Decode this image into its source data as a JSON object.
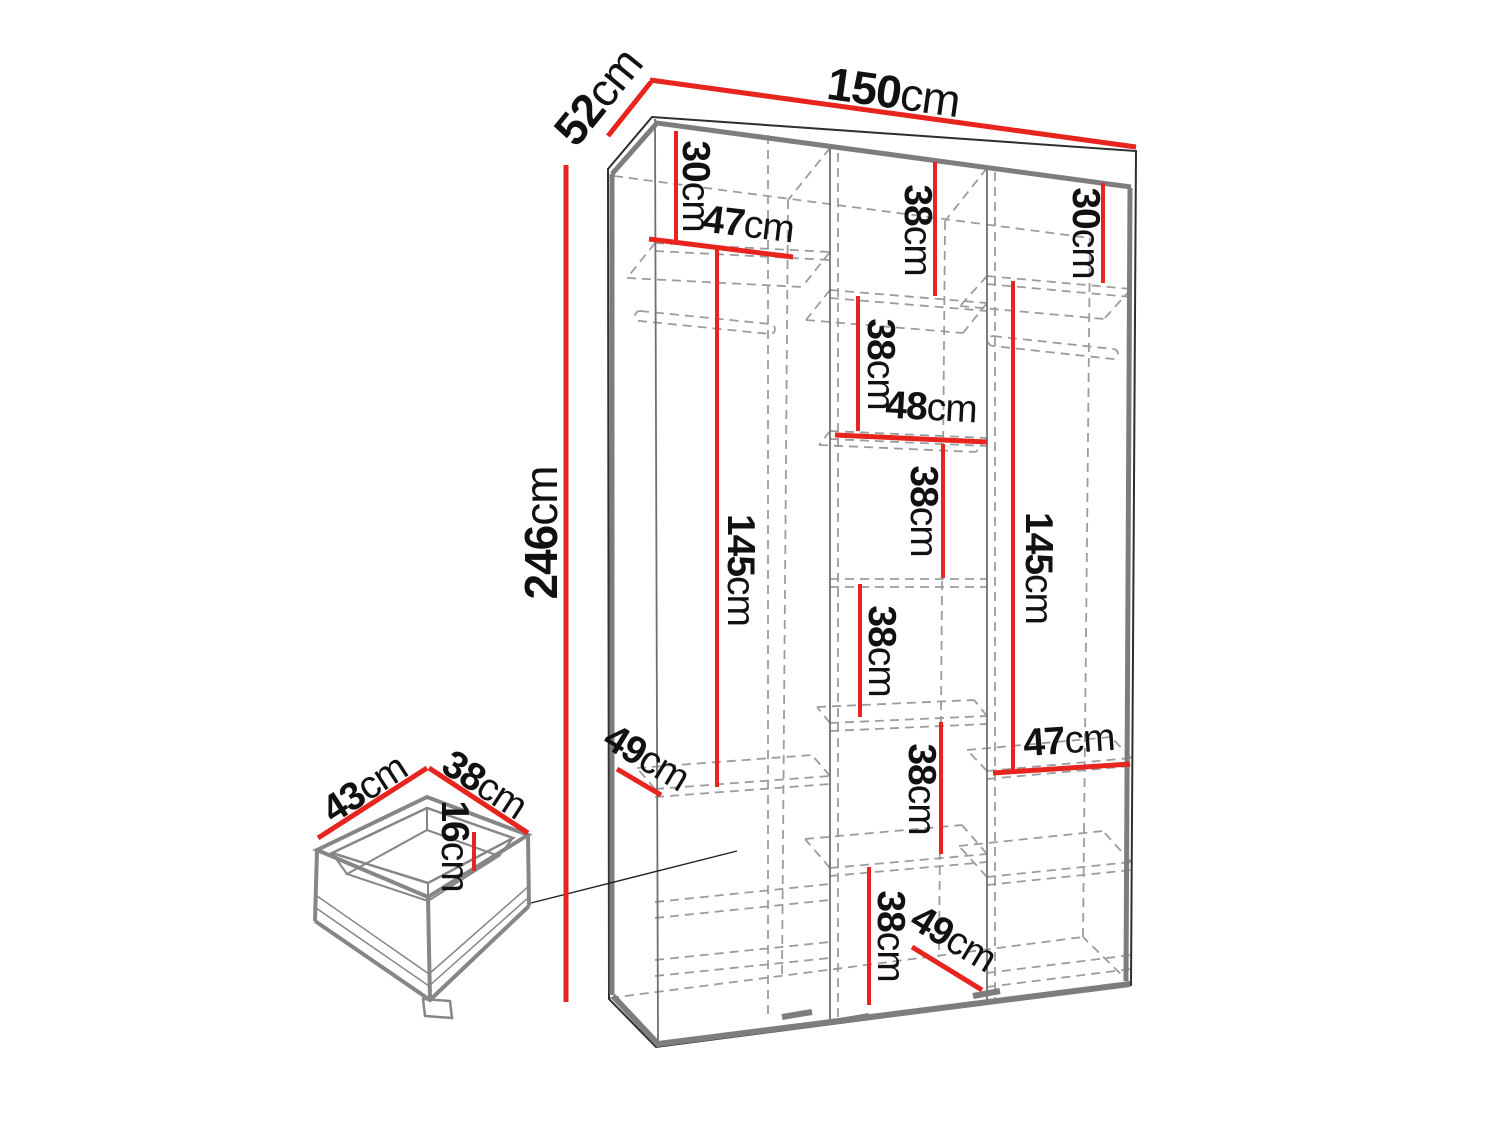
{
  "diagram": {
    "unit": "cm",
    "colors": {
      "dimension_line": "#e8241f",
      "outline": "#2e2e2e",
      "panel_gray": "#7d7d7d",
      "dashed_gray": "#9c9c9c",
      "label_text": "#111111",
      "background": "#ffffff"
    },
    "measurements": [
      {
        "id": "overall-width",
        "value": "150",
        "unit": "cm"
      },
      {
        "id": "overall-depth",
        "value": "52",
        "unit": "cm"
      },
      {
        "id": "overall-height",
        "value": "246",
        "unit": "cm"
      },
      {
        "id": "left-top-section",
        "value": "30",
        "unit": "cm"
      },
      {
        "id": "left-shelf-width",
        "value": "47",
        "unit": "cm"
      },
      {
        "id": "left-hanging-height",
        "value": "145",
        "unit": "cm"
      },
      {
        "id": "left-bottom-depth",
        "value": "49",
        "unit": "cm"
      },
      {
        "id": "middle-section-1",
        "value": "38",
        "unit": "cm"
      },
      {
        "id": "right-top-section",
        "value": "30",
        "unit": "cm"
      },
      {
        "id": "middle-section-2",
        "value": "38",
        "unit": "cm"
      },
      {
        "id": "middle-shelf-width",
        "value": "48",
        "unit": "cm"
      },
      {
        "id": "middle-section-3",
        "value": "38",
        "unit": "cm"
      },
      {
        "id": "right-hanging-height",
        "value": "145",
        "unit": "cm"
      },
      {
        "id": "middle-section-4",
        "value": "38",
        "unit": "cm"
      },
      {
        "id": "right-shelf-width",
        "value": "47",
        "unit": "cm"
      },
      {
        "id": "middle-section-5",
        "value": "38",
        "unit": "cm"
      },
      {
        "id": "middle-bottom-section",
        "value": "38",
        "unit": "cm"
      },
      {
        "id": "bottom-depth",
        "value": "49",
        "unit": "cm"
      },
      {
        "id": "drawer-depth",
        "value": "43",
        "unit": "cm"
      },
      {
        "id": "drawer-width",
        "value": "38",
        "unit": "cm"
      },
      {
        "id": "drawer-height",
        "value": "16",
        "unit": "cm"
      }
    ]
  }
}
